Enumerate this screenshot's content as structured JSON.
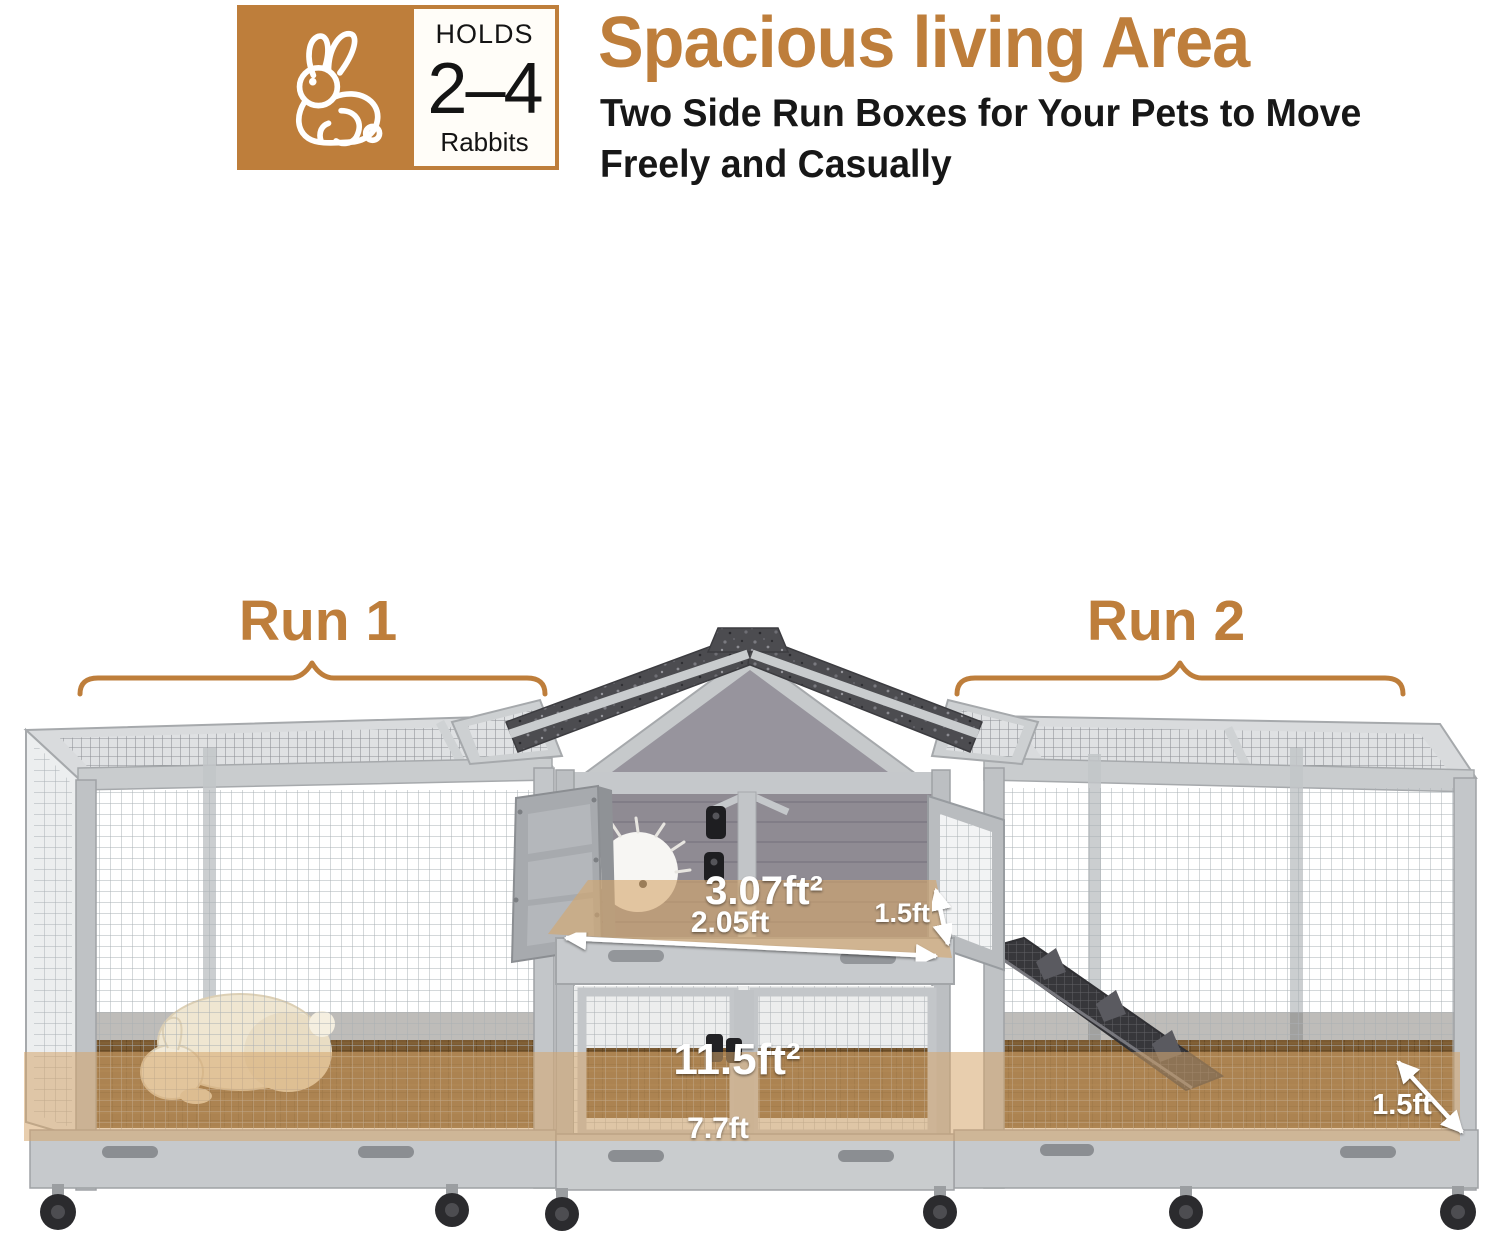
{
  "badge": {
    "holds": "HOLDS",
    "capacity": "2–4",
    "animal": "Rabbits",
    "icon": "rabbit-outline-icon"
  },
  "header": {
    "title": "Spacious living Area",
    "subtitle1": "Two Side Run Boxes for Your Pets to Move",
    "subtitle2": "Freely and Casually"
  },
  "runs": {
    "run1": "Run 1",
    "run2": "Run 2"
  },
  "dimensions": {
    "hutch_area": "3.07ft²",
    "hutch_width": "2.05ft",
    "hutch_depth": "1.5ft",
    "total_area": "11.5ft²",
    "total_width": "7.7ft",
    "run_depth": "1.5ft"
  },
  "colors": {
    "accent": "#BE7E3B",
    "roof_shingle": "#4C4C50",
    "frame_gray": "#C6C9CC",
    "floor_highlight": "#D5A66C",
    "dimension_text": "#FFFFFF"
  }
}
